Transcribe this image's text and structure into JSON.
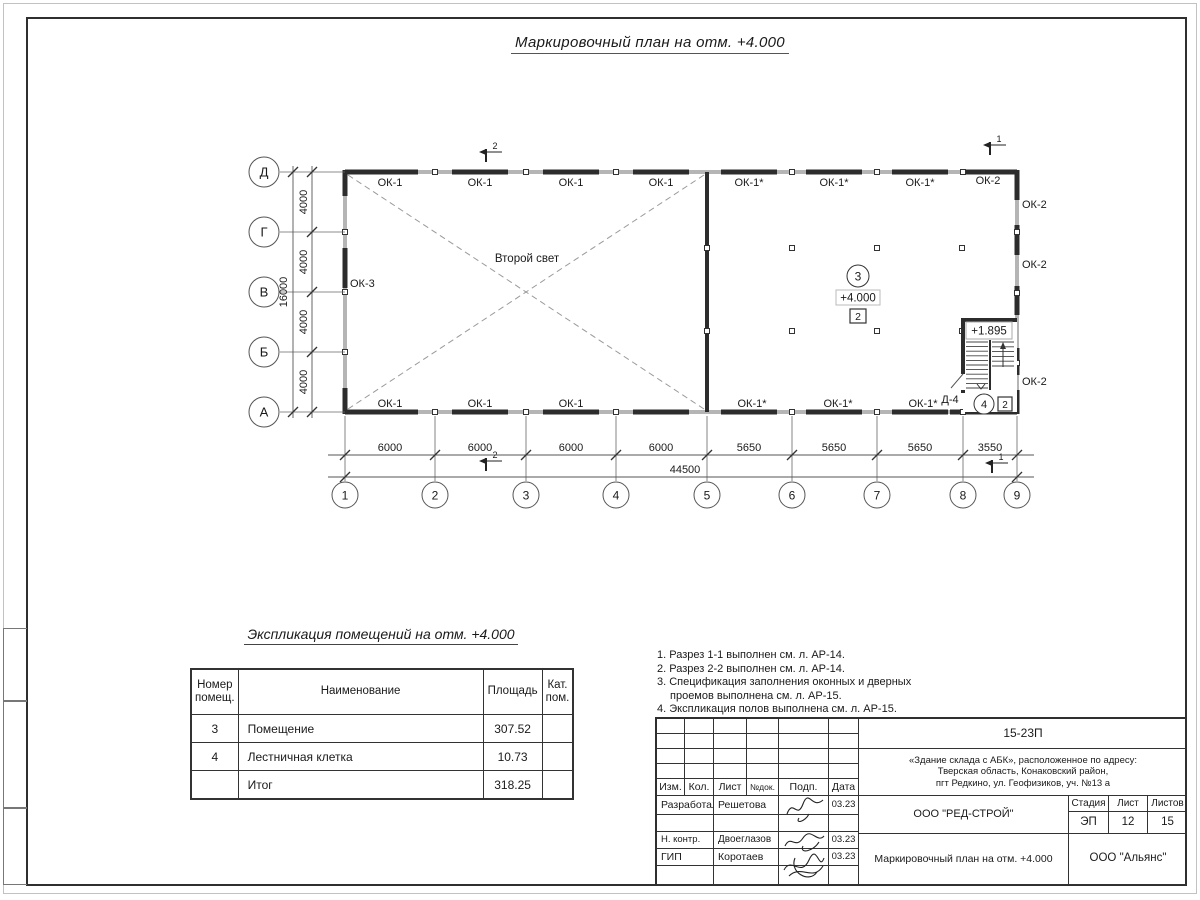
{
  "sheet": {
    "title": "Маркировочный план на отм. +4.000"
  },
  "plan": {
    "second_light_label": "Второй свет",
    "room3": {
      "number": "3",
      "level": "+4.000",
      "cat": "2"
    },
    "room4": {
      "number": "4",
      "cat": "2"
    },
    "stair_level": "+1.895",
    "door_label": "Д-4",
    "left_window_label": "ОК-3",
    "top_window_labels": [
      "ОК-1",
      "ОК-1",
      "ОК-1",
      "ОК-1",
      "ОК-1*",
      "ОК-1*",
      "ОК-1*",
      "ОК-2"
    ],
    "bottom_window_labels": [
      "ОК-1",
      "ОК-1",
      "ОК-1",
      "ОК-1*",
      "ОК-1*",
      "ОК-1*"
    ],
    "right_window_labels": [
      "ОК-2",
      "ОК-2",
      "ОК-2"
    ],
    "axes_letters": [
      "Д",
      "Г",
      "В",
      "Б",
      "А"
    ],
    "axes_numbers": [
      "1",
      "2",
      "3",
      "4",
      "5",
      "6",
      "7",
      "8",
      "9"
    ],
    "dims_bottom": [
      "6000",
      "6000",
      "6000",
      "6000",
      "5650",
      "5650",
      "5650",
      "3550"
    ],
    "dim_total_bottom": "44500",
    "dims_left": [
      "4000",
      "4000",
      "4000",
      "4000"
    ],
    "dim_total_left": "16000",
    "sections": {
      "s1": "1",
      "s2": "2"
    }
  },
  "explication": {
    "title": "Экспликация помещений на отм. +4.000",
    "headers": [
      "Номер помещ.",
      "Наименование",
      "Площадь",
      "Кат. пом."
    ],
    "rows": [
      {
        "num": "3",
        "name": "Помещение",
        "area": "307.52",
        "cat": ""
      },
      {
        "num": "4",
        "name": "Лестничная клетка",
        "area": "10.73",
        "cat": ""
      },
      {
        "num": "",
        "name": "Итог",
        "area": "318.25",
        "cat": ""
      }
    ]
  },
  "notes": {
    "lines": [
      "1. Разрез 1-1 выполнен см. л. АР-14.",
      "2. Разрез 2-2 выполнен см. л. АР-14.",
      "3. Спецификация заполнения оконных и дверных",
      "проемов выполнена см. л. АР-15.",
      "4. Экспликация полов выполнена см. л. АР-15."
    ]
  },
  "titleblock": {
    "doc_number": "15-23П",
    "address_line1": "«Здание склада с АБК», расположенное по адресу:",
    "address_line2": "Тверская область, Конаковский район,",
    "address_line3": "пгт Редкино, ул. Геофизиков, уч. №13 а",
    "col_izm": "Изм.",
    "col_kol": "Кол.",
    "col_list": "Лист",
    "col_ndoc": "№док.",
    "col_podp": "Подп.",
    "col_data": "Дата",
    "row1_role": "Разработал",
    "row1_name": "Решетова",
    "row1_date": "03.23",
    "row2_role": "Н. контр.",
    "row2_name": "Двоеглазов",
    "row2_date": "03.23",
    "row3_role": "ГИП",
    "row3_name": "Коротаев",
    "row3_date": "03.23",
    "developer": "ООО \"РЕД-СТРОЙ\"",
    "drawing_title": "Маркировочный план на отм. +4.000",
    "stage_label": "Стадия",
    "sheet_label": "Лист",
    "sheets_label": "Листов",
    "stage": "ЭП",
    "sheet_num": "12",
    "sheets_total": "15",
    "company": "ООО \"Альянс\""
  }
}
